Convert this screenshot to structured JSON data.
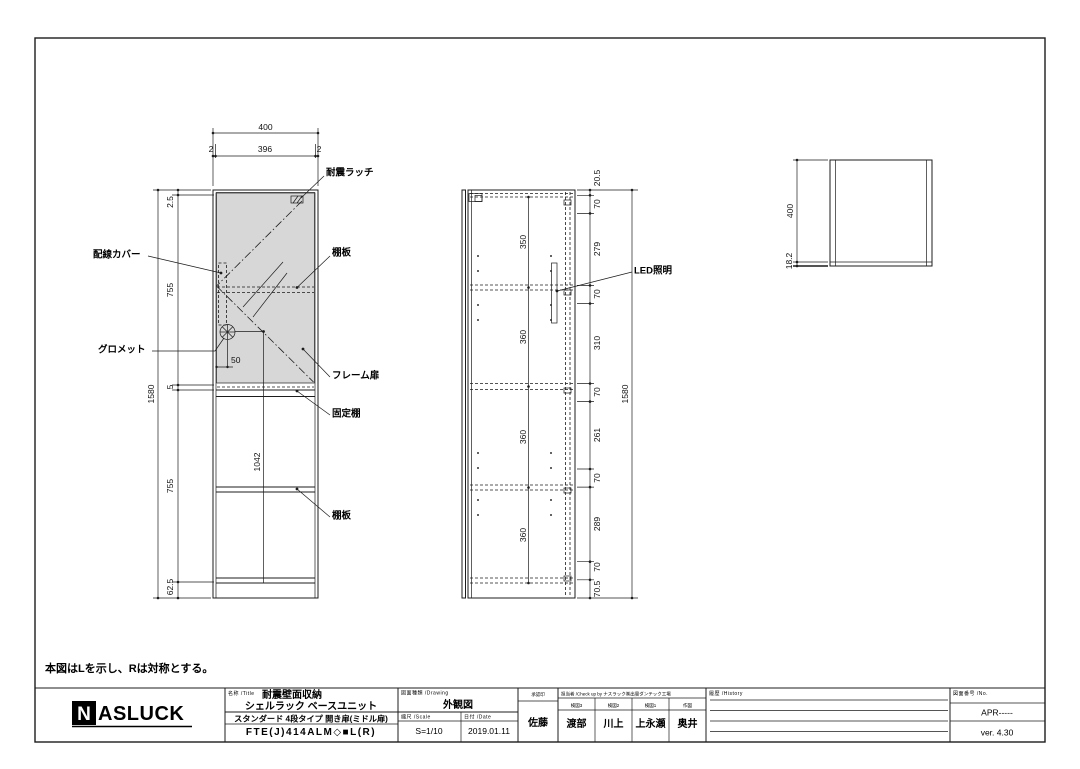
{
  "note": "本図はLを示し、Rは対称とする。",
  "front": {
    "top_dims": {
      "overall": "400",
      "left_edge": "2",
      "inner": "396",
      "right_edge": "2"
    },
    "left_dims": {
      "top_gap": "2.5",
      "upper": "755",
      "mid_gap": "5",
      "lower": "755",
      "base": "62.5",
      "overall": "1580"
    },
    "inner_dims": {
      "grommet_offset": "50",
      "lower_height": "1042"
    },
    "labels": {
      "latch": "耐震ラッチ",
      "wiring_cover": "配線カバー",
      "shelf_upper": "棚板",
      "grommet": "グロメット",
      "frame_door": "フレーム扉",
      "fixed_shelf": "固定棚",
      "shelf_lower": "棚板"
    }
  },
  "side": {
    "inner_dims": [
      "350",
      "360",
      "360",
      "360"
    ],
    "right_dims": [
      "20.5",
      "70",
      "279",
      "70",
      "310",
      "70",
      "261",
      "70",
      "289",
      "70",
      "70.5"
    ],
    "overall": "1580",
    "labels": {
      "led": "LED照明"
    }
  },
  "top": {
    "dims": {
      "depth": "400",
      "front_thickness": "18.2"
    }
  },
  "title_block": {
    "logo_n": "N",
    "logo_rest": "ASLUCK",
    "name_header": "名称 /Title",
    "product_title": "耐震壁面収納",
    "product_subtitle": "シェルラック ベースユニット",
    "product_type": "スタンダード 4段タイプ 開き扉(ミドル扉)",
    "model_code": "FTE(J)414ALM◇■L(R)",
    "drawing_header": "図面種類 /Drawing",
    "drawing_type": "外観図",
    "scale_header": "縮尺 /Scale",
    "scale_value": "S=1/10",
    "date_header": "日付 /Date",
    "date_value": "2019.01.11",
    "approval_header": "承認印",
    "approver": "佐藤",
    "check_header": "担当者 /Check up by ナスラック㈱出雲ダンテック工場",
    "check_cols": [
      {
        "role": "検図3",
        "name": "渡部"
      },
      {
        "role": "検図2",
        "name": "川上"
      },
      {
        "role": "検図1",
        "name": "上永瀬"
      },
      {
        "role": "作図",
        "name": "奥井"
      }
    ],
    "history_header": "履歴 /History",
    "number_header": "図面番号 /No.",
    "drawing_number": "APR-----",
    "version": "ver. 4.30"
  }
}
